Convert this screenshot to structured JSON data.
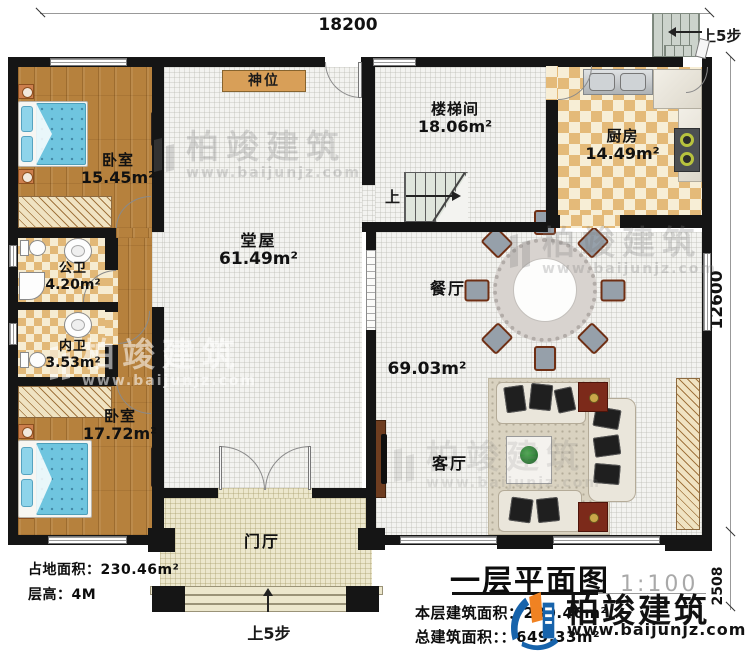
{
  "dimensions": {
    "width_top": "18200",
    "depth_main": "12600",
    "depth_porch": "2508"
  },
  "rooms": {
    "bedroom1": {
      "name": "卧室",
      "area": "15.45m²"
    },
    "shrine": {
      "name": "神位"
    },
    "stairwell": {
      "name": "楼梯间",
      "area": "18.06m²"
    },
    "kitchen": {
      "name": "厨房",
      "area": "14.49m²"
    },
    "hall": {
      "name": "堂屋",
      "area": "61.49m²"
    },
    "public_bath": {
      "name": "公卫",
      "area": "4.20m²"
    },
    "private_bath": {
      "name": "内卫",
      "area": "3.53m²"
    },
    "bedroom2": {
      "name": "卧室",
      "area": "17.72m²"
    },
    "dining": {
      "name": "餐厅"
    },
    "dining_living_area": "69.03m²",
    "living": {
      "name": "客厅"
    },
    "foyer": {
      "name": "门厅"
    }
  },
  "stairs": {
    "up_label": "上",
    "exterior_steps_label": "上5步",
    "entrance_steps_label": "上5步"
  },
  "info": {
    "site_area_label": "占地面积：",
    "site_area_value": "230.46m²",
    "floor_height_label": "层高：",
    "floor_height_value": "4M"
  },
  "title_block": {
    "title": "一层平面图",
    "scale": "1:100",
    "floor_area_label": "本层建筑面积：",
    "floor_area_value": "230.46m²",
    "total_area_label": "总建筑面积：",
    "total_area_value": "：649.33m²",
    "brand": "柏竣建筑",
    "website": "www.baijunjz.com"
  },
  "watermark": {
    "brand": "柏竣建筑",
    "website": "www.baijunjz.com"
  },
  "colors": {
    "wall": "#151515",
    "wood_floor": "#b6813d",
    "checker_dark": "#e2b877",
    "tile_light": "#f3f3f0",
    "porch": "#ece7cd",
    "bed": "#6fc5df",
    "shrine": "#d89f58",
    "logo_blue": "#1763ab",
    "logo_orange": "#f08222"
  }
}
